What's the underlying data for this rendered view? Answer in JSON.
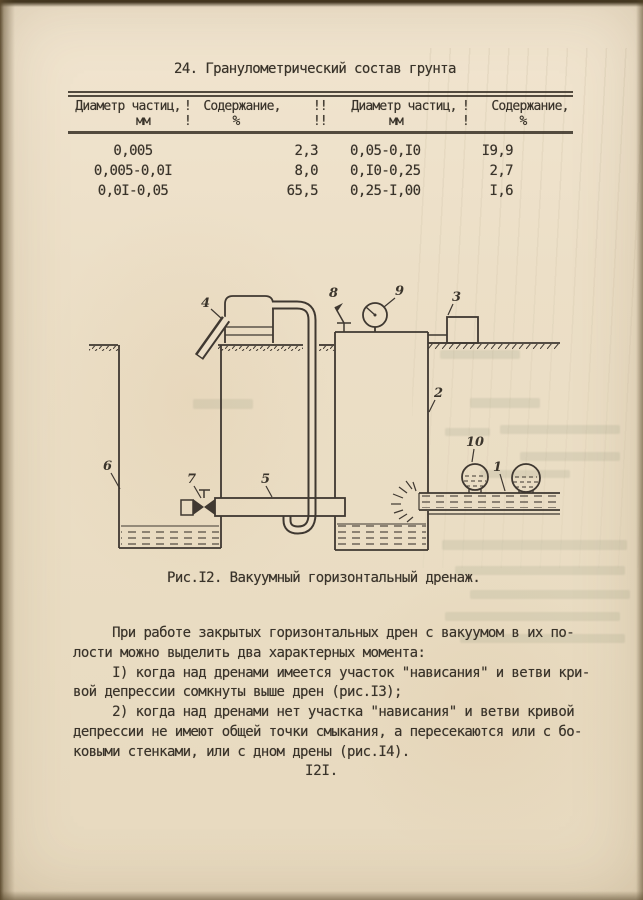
{
  "table": {
    "title": "24. Гранулометрический состав грунта",
    "col_headers": [
      {
        "label": "Диаметр частиц,",
        "unit": "мм"
      },
      {
        "label": "Содержание,",
        "unit": "%"
      },
      {
        "label": "Диаметр частиц,",
        "unit": "мм"
      },
      {
        "label": "Содержание,",
        "unit": "%"
      }
    ],
    "separators": [
      "!",
      "!!",
      "!"
    ],
    "rows": [
      [
        "0,005",
        "2,3",
        "0,05-0,I0",
        "I9,9"
      ],
      [
        "0,005-0,0I",
        "8,0",
        "0,I0-0,25",
        "2,7"
      ],
      [
        "0,0I-0,05",
        "65,5",
        "0,25-I,00",
        "I,6"
      ]
    ]
  },
  "figure": {
    "caption": "Рис.I2. Вакуумный горизонтальный дренаж.",
    "labels": [
      "1",
      "2",
      "3",
      "4",
      "5",
      "6",
      "7",
      "8",
      "9",
      "10"
    ]
  },
  "body": {
    "lines": [
      "     При работе закрытых горизонтальных дрен с вакуумом в их по-",
      "лости можно выделить два характерных момента:",
      "     I) когда над дренами имеется участок \"нависания\" и ветви кри-",
      "вой депрессии сомкнуты выше дрен (рис.I3);",
      "     2) когда над дренами нет участка \"нависания\" и ветви кривой",
      "депрессии не имеют общей точки смыкания, а пересекаются или с бо-",
      "ковыми стенками, или с дном дрены (рис.I4)."
    ]
  },
  "page": {
    "number": "I2I."
  }
}
